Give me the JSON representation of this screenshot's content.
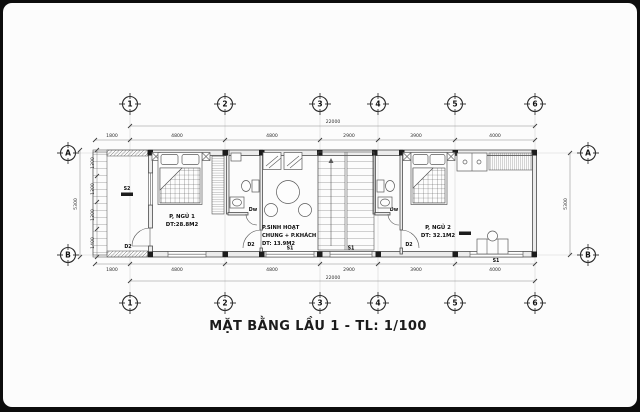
{
  "title": "MẶT BẰNG LẦU 1 - TL: 1/100",
  "grid": {
    "cols": [
      "1",
      "2",
      "3",
      "4",
      "5",
      "6"
    ],
    "rows": [
      "A",
      "B"
    ]
  },
  "rooms": {
    "bedroom1": {
      "name": "P, NGỦ 1",
      "area": "DT:28.8M2"
    },
    "living": {
      "line1": "P.SINH HOẠT",
      "line2": "CHUNG + P.KHÁCH",
      "area": "DT: 13.9M2"
    },
    "bedroom2": {
      "name": "P, NGỦ 2",
      "area": "DT: 32.1M2"
    }
  },
  "labels": {
    "door": "D2",
    "toilet_door": "Dw",
    "window1": "S1",
    "window2": "S2"
  },
  "dimensions": {
    "top_chain": [
      "1800",
      "4800",
      "4800",
      "2900",
      "3900",
      "4000"
    ],
    "top_total": "22000",
    "bottom_chain": [
      "1800",
      "4800",
      "4800",
      "2900",
      "3900",
      "4000"
    ],
    "bottom_total": "22000",
    "left_chain": [
      "1300",
      "1300",
      "1300",
      "1400"
    ],
    "left_total": "5300",
    "right_total": "5300"
  },
  "colors": {
    "paper": "#fcfcfc",
    "frame": "#0d0d0d",
    "line": "#4c4c4c"
  }
}
